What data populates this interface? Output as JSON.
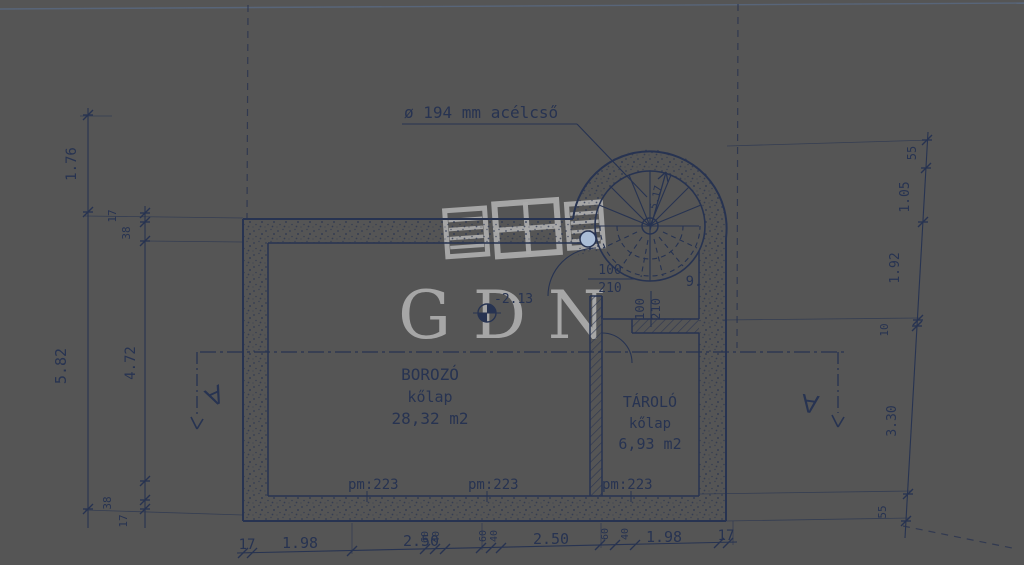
{
  "document": {
    "kind": "scanned basement floor plan",
    "watermark": "GDN"
  },
  "annotations": {
    "pipe": "ø 194 mm acélcső",
    "level": "-2.13",
    "stair_number": "9.",
    "flight_label": "5.17",
    "section_left": "A",
    "section_right": "A"
  },
  "rooms": [
    {
      "name": "BOROZÓ",
      "floor": "kőlap",
      "area": "28,32 m2"
    },
    {
      "name": "TÁROLÓ",
      "floor": "kőlap",
      "area": "6,93 m2"
    }
  ],
  "sills": [
    "pm:223",
    "pm:223",
    "pm:223"
  ],
  "doors": [
    {
      "width": "100",
      "height": "210"
    },
    {
      "width": "100",
      "height": "210"
    }
  ],
  "dims": {
    "left_outer": [
      "1.76",
      "5.82"
    ],
    "left_inner": [
      "17",
      "38",
      "4.72",
      "38",
      "17"
    ],
    "right": [
      "55",
      "1.05",
      "1.92",
      "10",
      "3.30",
      "55"
    ],
    "bottom_main": [
      "17",
      "1.98",
      "2.50",
      "2.50",
      "1.98",
      "17"
    ],
    "bottom_small": [
      "60",
      "40",
      "60",
      "40",
      "60",
      "40"
    ]
  },
  "colors": {
    "paper_left": "#f3e8ca",
    "paper_right": "#8da4c5",
    "ink": "#273351"
  }
}
